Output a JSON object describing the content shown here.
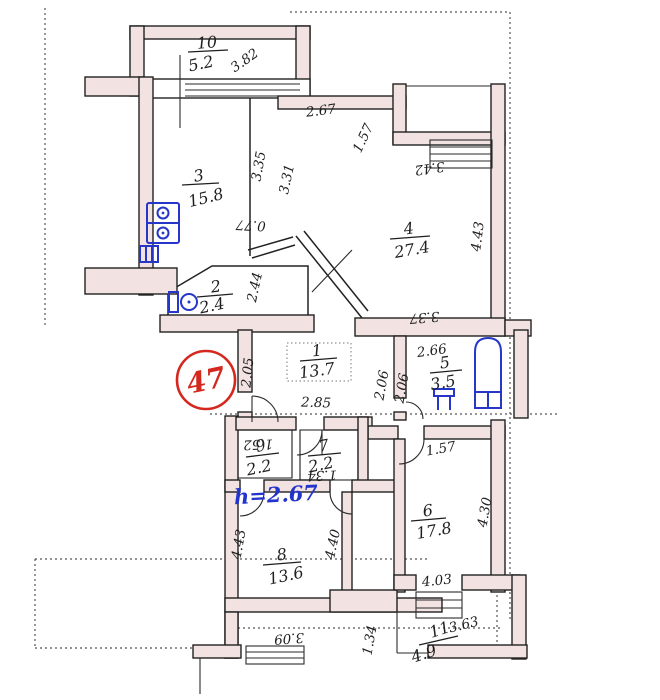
{
  "document": {
    "type": "hand-drawn apartment floor plan (BTI technical passport sheet)",
    "apartment_number": "47",
    "ceiling_height_note": "h=2.67"
  },
  "rooms": {
    "1": {
      "number": "1",
      "area": "13.7"
    },
    "2": {
      "number": "2",
      "area": "2.4"
    },
    "3": {
      "number": "3",
      "area": "15.8"
    },
    "4": {
      "number": "4",
      "area": "27.4"
    },
    "5": {
      "number": "5",
      "area": "3.5"
    },
    "6": {
      "number": "6",
      "area": "17.8"
    },
    "7": {
      "number": "7",
      "area": "2.2"
    },
    "8": {
      "number": "8",
      "area": "13.6"
    },
    "9": {
      "number": "9",
      "area": "2.2"
    },
    "10": {
      "number": "10",
      "area": "5.2"
    },
    "11": {
      "number": "11",
      "area": "4.9"
    }
  },
  "dimensions": {
    "room10_width": "3.82",
    "room3_right": "3.35",
    "room3_niche": "0.77",
    "room4_top": "2.67",
    "room4_left": "3.31",
    "room4_notch": "1.57",
    "room4_entry_top": "3.42",
    "room4_right": "4.43",
    "room4_bottom": "3.37",
    "hall_niche": "2.44",
    "hall_left": "2.05",
    "hall_width": "2.85",
    "bath_top": "2.66",
    "bath_left_outer": "2.06",
    "bath_left_inner": "2.06",
    "closet9_top": "1.52",
    "closet7_bottom": "1.34",
    "room6_top": "1.57",
    "room6_right": "4.30",
    "room8_left": "4.43",
    "room8_right": "4.40",
    "room8_bottom": "3.09",
    "entry_passage": "1.34",
    "balcony_top": "4.03",
    "balcony_diagonal": "3.63"
  },
  "annotations": {
    "apartment_badge": "47",
    "height_note": "h=2.67"
  },
  "colors": {
    "paper": "#ffffff",
    "ink": "#1f1f1f",
    "wall_fill": "#f2e2e2",
    "fixture_blue": "#2636c8",
    "badge_red": "#d4281f",
    "note_blue": "#2334cc"
  }
}
